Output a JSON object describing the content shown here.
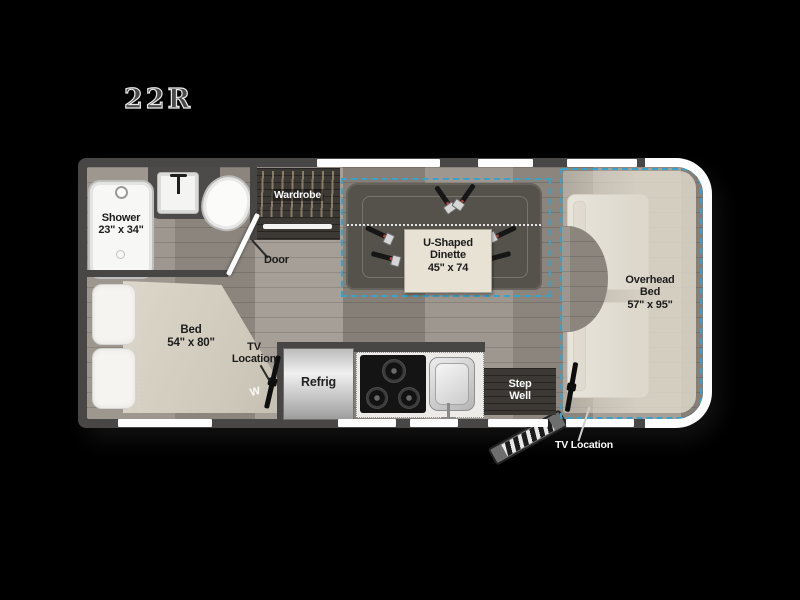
{
  "title": "22R",
  "floorplan": {
    "bathroom": {
      "shower_line1": "Shower",
      "shower_line2": "23\" x 34\"",
      "door": "Door"
    },
    "wardrobe": "Wardrobe",
    "dinette": {
      "line1": "U-Shaped",
      "line2": "Dinette",
      "line3": "45\" x 74"
    },
    "bedroom": {
      "bed_line1": "Bed",
      "bed_line2": "54\" x 80\"",
      "tv_line1": "TV",
      "tv_line2": "Location",
      "monogram": "W"
    },
    "kitchen": {
      "refrigerator": "Refrig"
    },
    "entry": {
      "step_line1": "Step",
      "step_line2": "Well"
    },
    "cab": {
      "bed_line1": "Overhead",
      "bed_line2": "Bed",
      "bed_line3": "57\" x 95\"",
      "tv_label": "TV Location"
    }
  },
  "colors": {
    "slide_accent": "#3aa2c8",
    "wall": "#484746",
    "floor": "#958f88",
    "furniture_tan": "#d9d3c6",
    "bench_gray": "#55514b"
  }
}
